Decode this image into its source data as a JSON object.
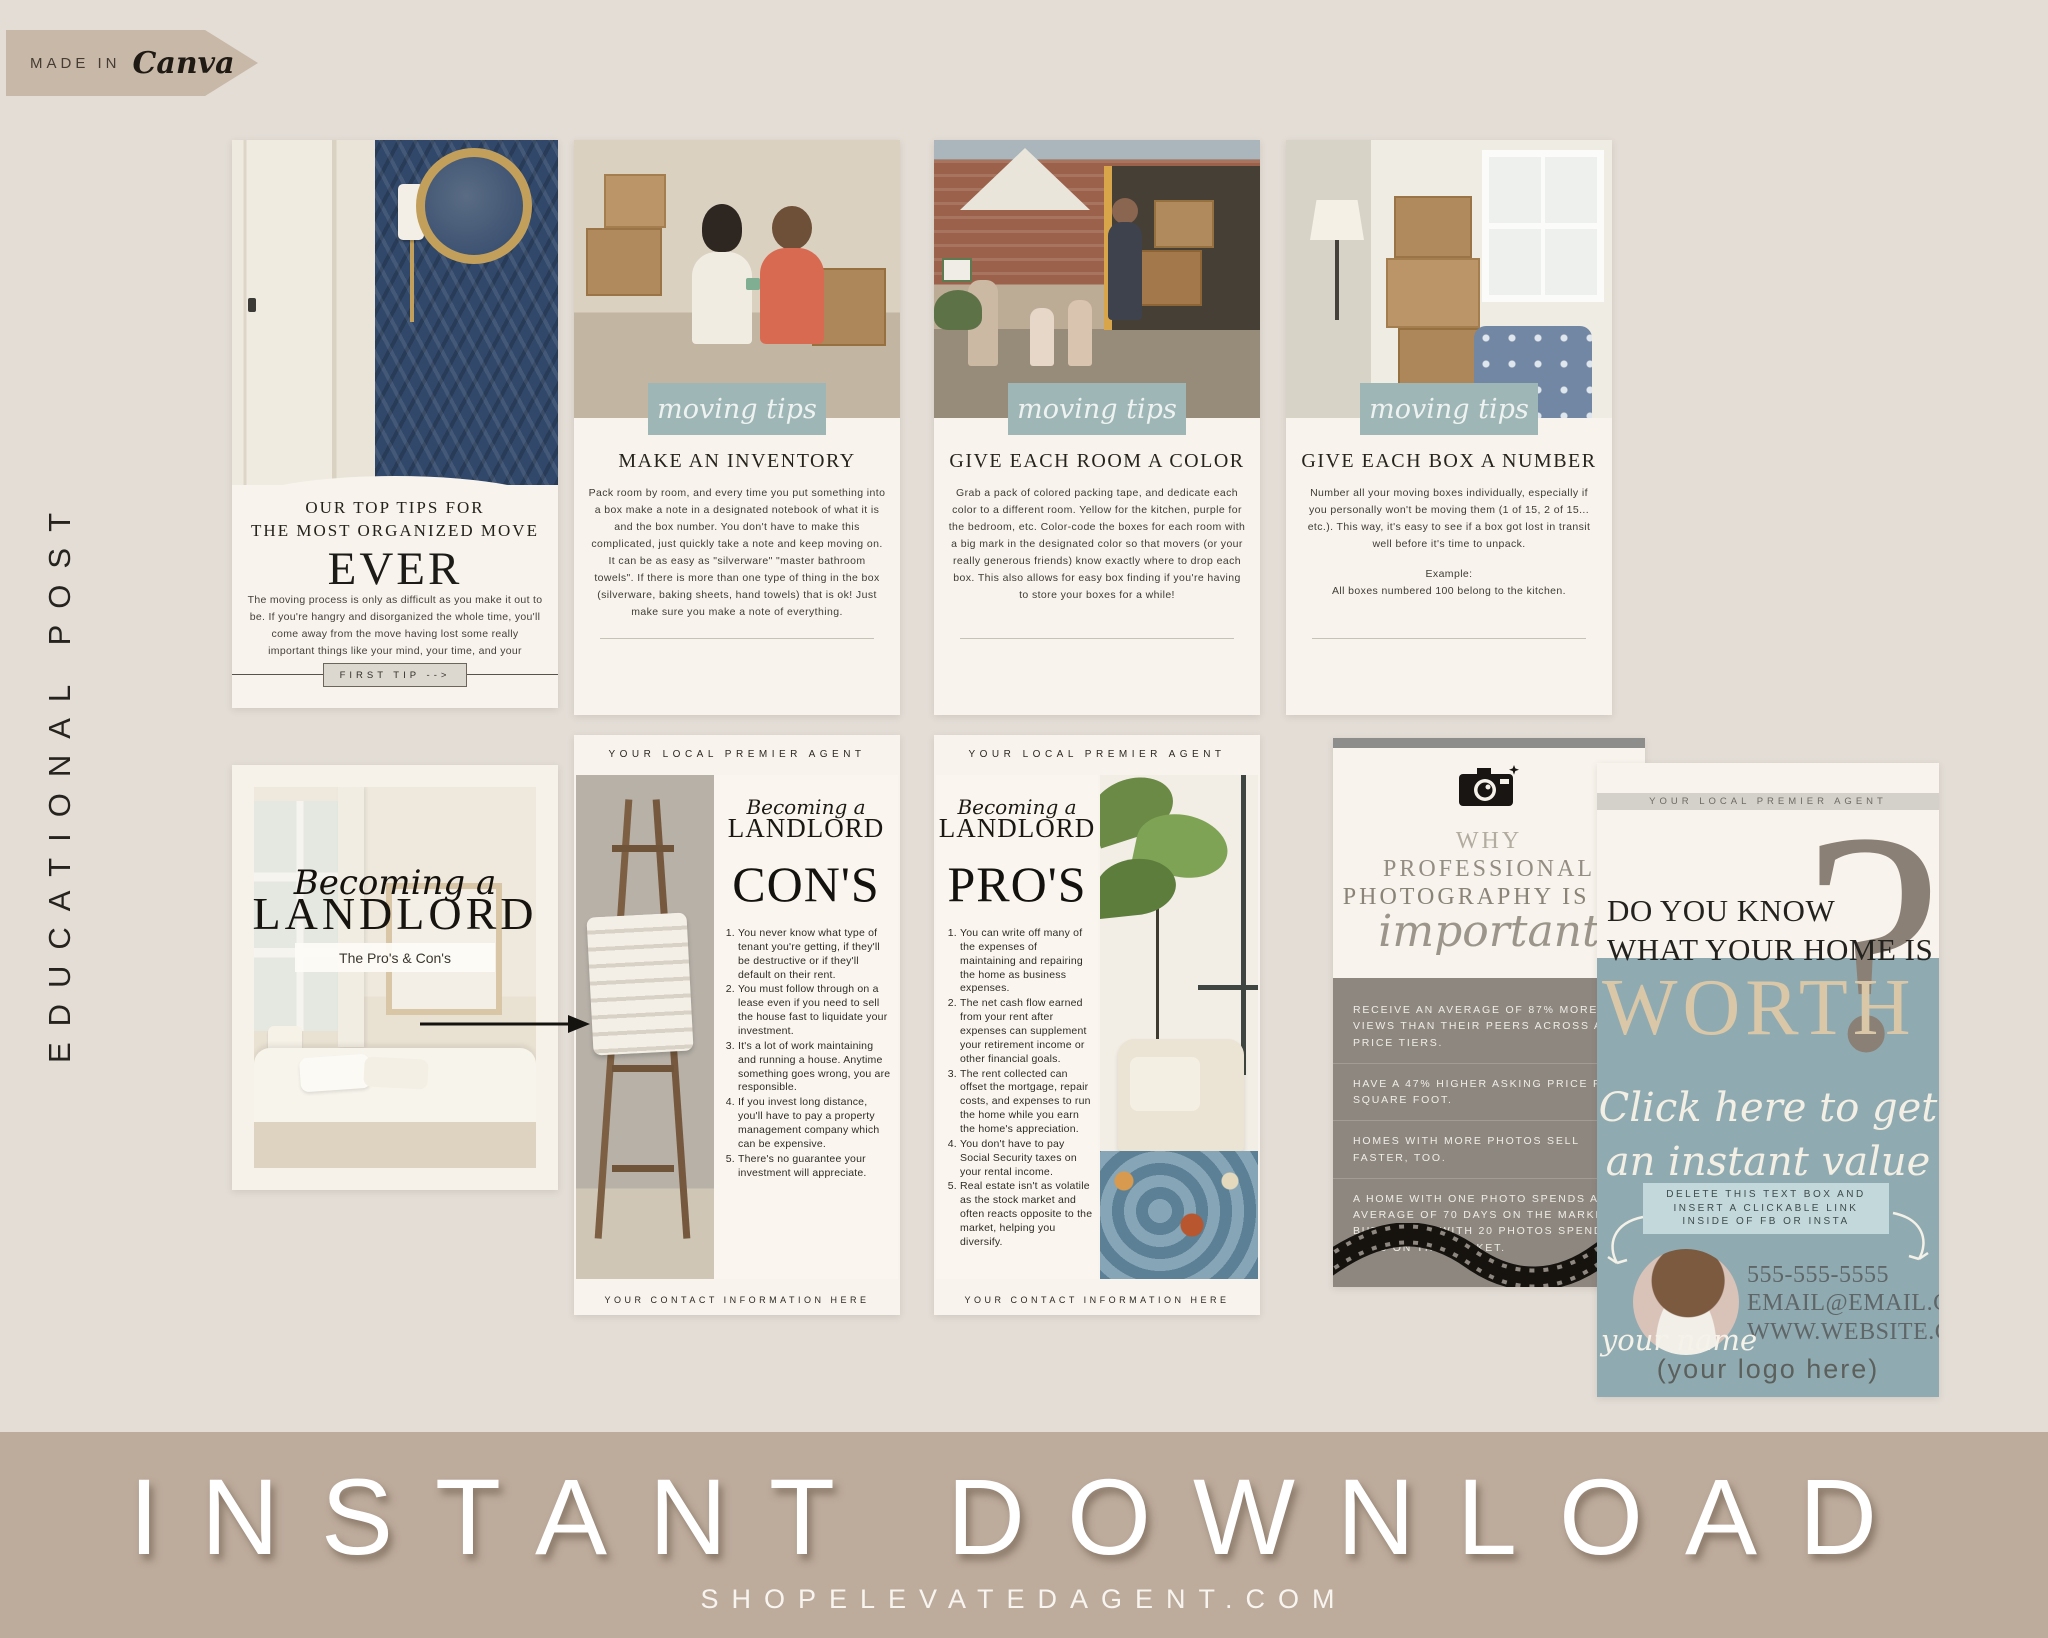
{
  "badge": {
    "prefix": "MADE IN",
    "brand": "Canva"
  },
  "side_label": "EDUCATIONAL POST",
  "colors": {
    "background": "#e3ddd6",
    "card_cream": "#f8f4ed",
    "sage": "#a5bbba",
    "teal": "#8fabb1",
    "taupe_gray": "#8e8780",
    "bottom_bar": "#bdab9c",
    "navy": "#31486a",
    "tan": "#d9c7a8"
  },
  "contact_bar": {
    "email": "EMAIL@EMAILEMAIL.COM",
    "phone": "555-555-555",
    "website": "WWW.YOURSITE.COM"
  },
  "cards": {
    "organized_move": {
      "title_line1": "OUR TOP TIPS FOR",
      "title_line2": "THE MOST ORGANIZED MOVE",
      "title_big": "EVER",
      "body": "The moving process is only as difficult as you make it out to be. If you're hangry and disorganized the whole time, you'll come away from the move having lost some really important things like your mind, your time, and your grandmother's china.",
      "button": "FIRST TIP -->"
    },
    "inventory": {
      "badge": "moving tips",
      "heading": "MAKE AN INVENTORY",
      "body": "Pack room by room, and every time you put something into a box make a note in a designated notebook of what it is and the box number. You don't have to make this complicated, just quickly take a note and keep moving on. It can be as easy as \"silverware\" \"master bathroom towels\". If there is more than one type of thing in the box (silverware, baking sheets, hand towels) that is ok! Just make sure you make a note of everything."
    },
    "room_color": {
      "badge": "moving tips",
      "heading": "GIVE EACH ROOM A COLOR",
      "body": "Grab a pack of colored packing tape, and dedicate each color to a different room. Yellow for the kitchen, purple for the bedroom, etc. Color-code the boxes for each room with a big mark in the designated color so that movers (or your really generous friends) know exactly where to drop each box. This also allows for easy box finding if you're having to store your boxes for a while!"
    },
    "box_number": {
      "badge": "moving tips",
      "heading": "GIVE EACH BOX A NUMBER",
      "body": "Number all your moving boxes individually, especially if you personally won't be moving them (1 of 15, 2 of 15... etc.). This way, it's easy to see if a box got lost in transit well before it's time to unpack.",
      "example_label": "Example:",
      "example": "All boxes numbered 100 belong to the kitchen."
    },
    "landlord_cover": {
      "script": "Becoming a",
      "title": "LANDLORD",
      "subtitle": "The Pro's & Con's"
    },
    "landlord_cons": {
      "header": "YOUR LOCAL PREMIER AGENT",
      "script": "Becoming a",
      "title": "LANDLORD",
      "heading": "CON'S",
      "items": [
        "You never know what type of tenant you're getting, if they'll be destructive or if they'll default on their rent.",
        "You must follow through on a lease even if you need to sell the house fast to liquidate your investment.",
        "It's a lot of work maintaining and running a house. Anytime something goes wrong, you are responsible.",
        "If you invest long distance, you'll have to pay a property management company which can be expensive.",
        "There's no guarantee your investment will appreciate."
      ],
      "footer": "YOUR CONTACT INFORMATION HERE"
    },
    "landlord_pros": {
      "header": "YOUR LOCAL PREMIER AGENT",
      "script": "Becoming a",
      "title": "LANDLORD",
      "heading": "PRO'S",
      "items": [
        "You can write off many of the expenses of maintaining and repairing the home as business expenses.",
        "The net cash flow earned from your rent after expenses can supplement your retirement income or other financial goals.",
        "The rent collected can offset the mortgage, repair costs, and expenses to run the home while you earn the home's appreciation.",
        "You don't have to pay Social Security taxes on your rental income.",
        "Real estate isn't as volatile as the stock market and often reacts opposite to the market, helping you diversify."
      ],
      "footer": "YOUR CONTACT INFORMATION HERE"
    },
    "photography": {
      "line1": "WHY",
      "line2": "PROFESSIONAL",
      "line3": "PHOTOGRAPHY IS SO",
      "script": "important",
      "bullets": [
        "RECEIVE AN AVERAGE OF 87% MORE VIEWS THAN THEIR PEERS ACROSS ALL PRICE TIERS.",
        "HAVE A 47% HIGHER ASKING PRICE PER SQUARE FOOT.",
        "HOMES WITH MORE PHOTOS SELL FASTER, TOO.",
        "A HOME WITH ONE PHOTO SPENDS AN AVERAGE OF 70 DAYS ON THE MARKET BUT A HOME WITH 20 PHOTOS SPENDS 32 DAYS ON THE MARKET."
      ]
    },
    "home_worth": {
      "header": "YOUR LOCAL PREMIER AGENT",
      "question_line1": "DO YOU KNOW",
      "question_line2": "WHAT YOUR HOME IS",
      "worth": "WORTH",
      "qmark": "?",
      "cta_line1": "Click here to get",
      "cta_line2": "an instant value",
      "note_line1": "DELETE THIS TEXT BOX AND",
      "note_line2": "INSERT A CLICKABLE LINK",
      "note_line3": "INSIDE OF FB OR INSTA",
      "name_script": "your name",
      "phone": "555-555-5555",
      "email": "EMAIL@EMAIL.COM",
      "website": "WWW.WEBSITE.COM",
      "logo_placeholder": "(your logo here)"
    }
  },
  "footer_bar": {
    "title": "INSTANT DOWNLOAD",
    "website": "SHOPELEVATEDAGENT.COM"
  }
}
